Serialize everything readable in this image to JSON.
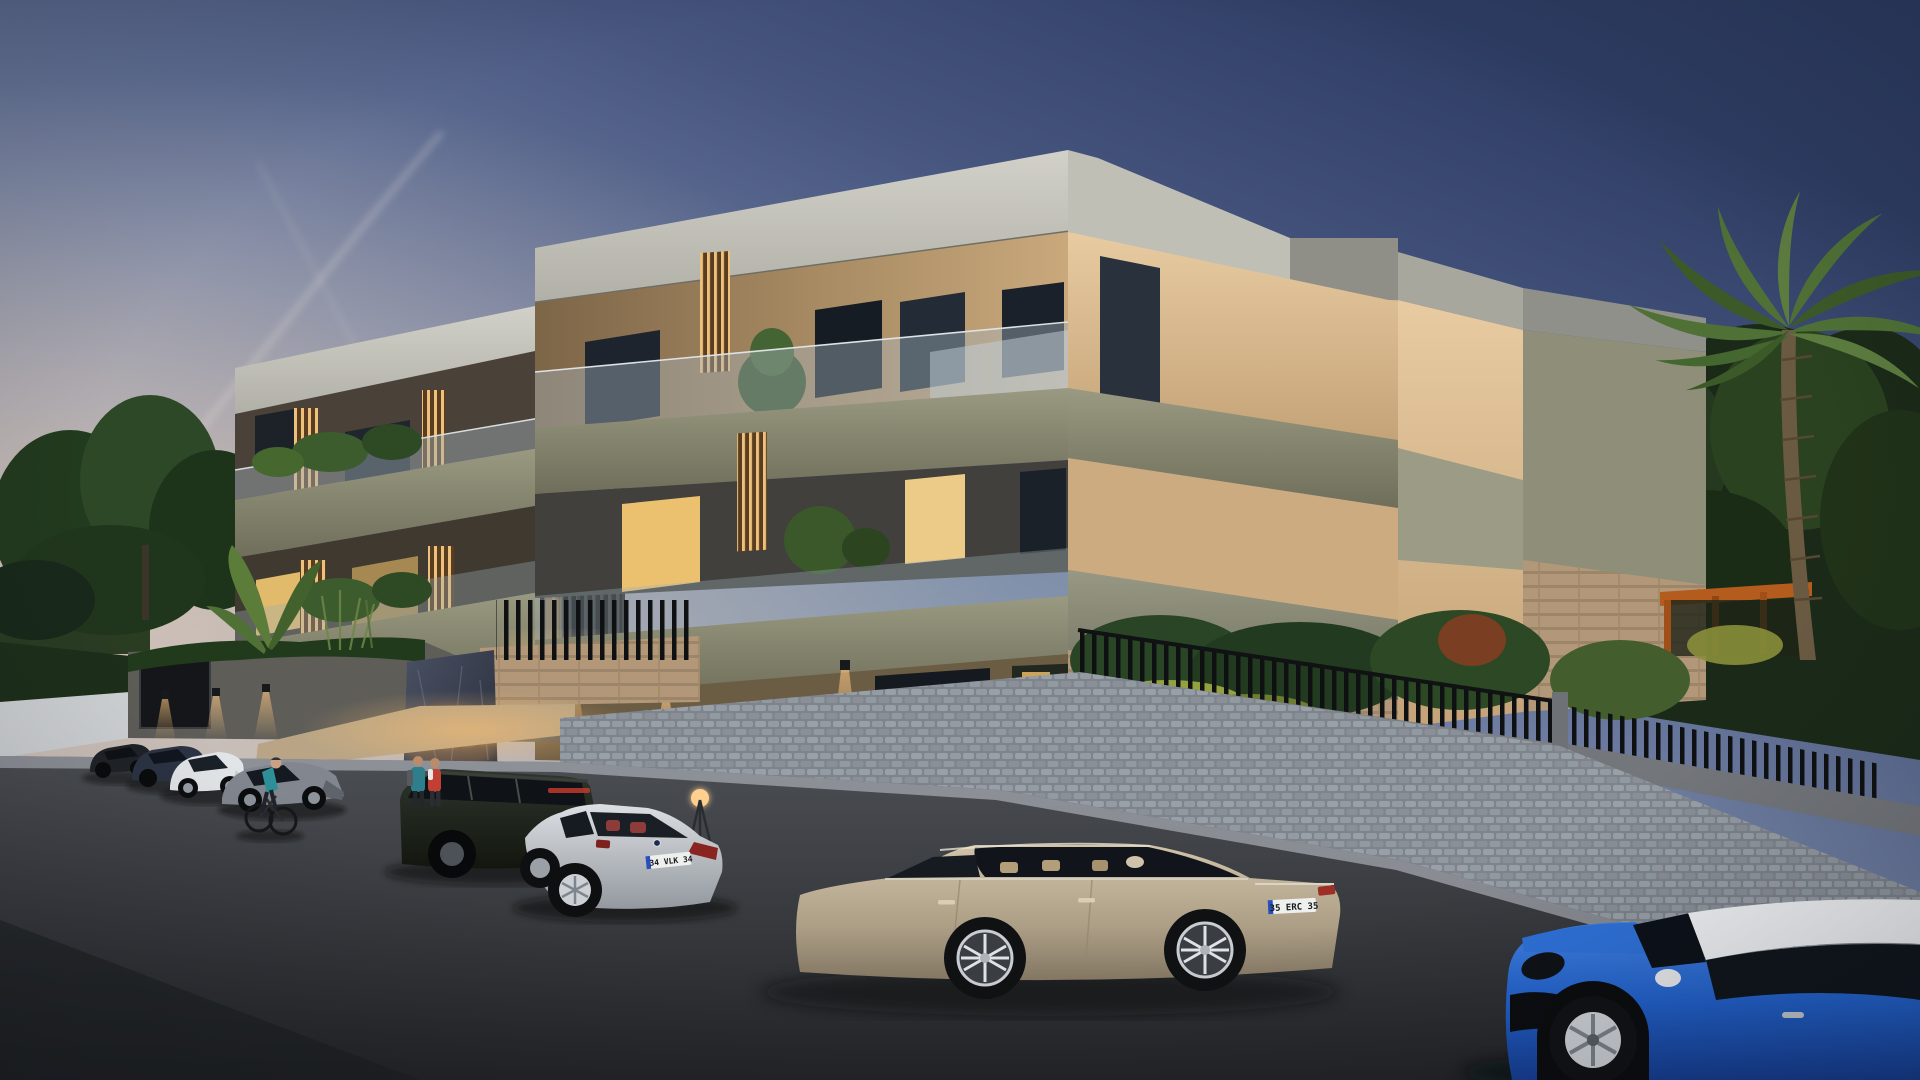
{
  "scene": {
    "description": "Photorealistic dusk rendering of a modern three-storey residential complex with illuminated balconies, landscaped perimeter wall, and cars parked along the street",
    "time_of_day": "dusk",
    "sky_top_color": "#2e3d64",
    "sky_horizon_color": "#dccfc0",
    "contrail_count": 2
  },
  "building": {
    "storeys": 3,
    "style": "modern flat-roof blocks with recessed balconies",
    "materials": {
      "fascia": "#c6c5bd",
      "timber_facade": "#c2a077",
      "olive_parapet_bands": "#8e8e78",
      "travertine_side_wall": "#e0c096",
      "sage_panel": "#9c9c86"
    },
    "balcony_rail": "frameless glass",
    "window_glow_color": "#ffd98f",
    "louvre_backlight_color": "#edc07c"
  },
  "signage": {
    "project_name": "EDZEN",
    "sign_backlight_color": "#ffb347",
    "pillar_material": "dark marble"
  },
  "vehicles": {
    "sedan_dark": {
      "label": "dark sedan",
      "body_color": "#1f2328"
    },
    "sedan_blue": {
      "label": "dark blue sedan",
      "body_color": "#2b3444"
    },
    "coupe_white": {
      "label": "white sports coupe",
      "body_color": "#e3e6e8"
    },
    "granturismo_gray": {
      "label": "gray grand tourer",
      "body_color": "#82878f"
    },
    "range_rover": {
      "label": "dark green SUV",
      "body_color": "#222921",
      "plate": "35 KVM 35"
    },
    "bmw_coupe": {
      "label": "silver coupe",
      "body_color": "#c3c6ca",
      "plate": "34 VLK 34"
    },
    "audi_sedan": {
      "label": "champagne luxury sedan",
      "body_color": "#b5a78d",
      "plate": "35 ERC 35"
    },
    "mini_cooper": {
      "label": "blue hatchback with white roof",
      "body_color": "#2263cf",
      "roof_color": "#f2f4f6"
    }
  },
  "people": {
    "cyclist": {
      "shirt_color": "#2e8f98"
    },
    "pedestrians_at_entrance": 2
  },
  "landscape": {
    "palm_trees": 1,
    "banana_plants": true,
    "hedges_lit": true,
    "pergola_color": "#b35c1e",
    "autumn_leaves_on_driveway": true
  },
  "street": {
    "asphalt_color": "#303338",
    "cobblestone_color": "#959ba3",
    "wall_downlight_color": "#ffc37a"
  }
}
